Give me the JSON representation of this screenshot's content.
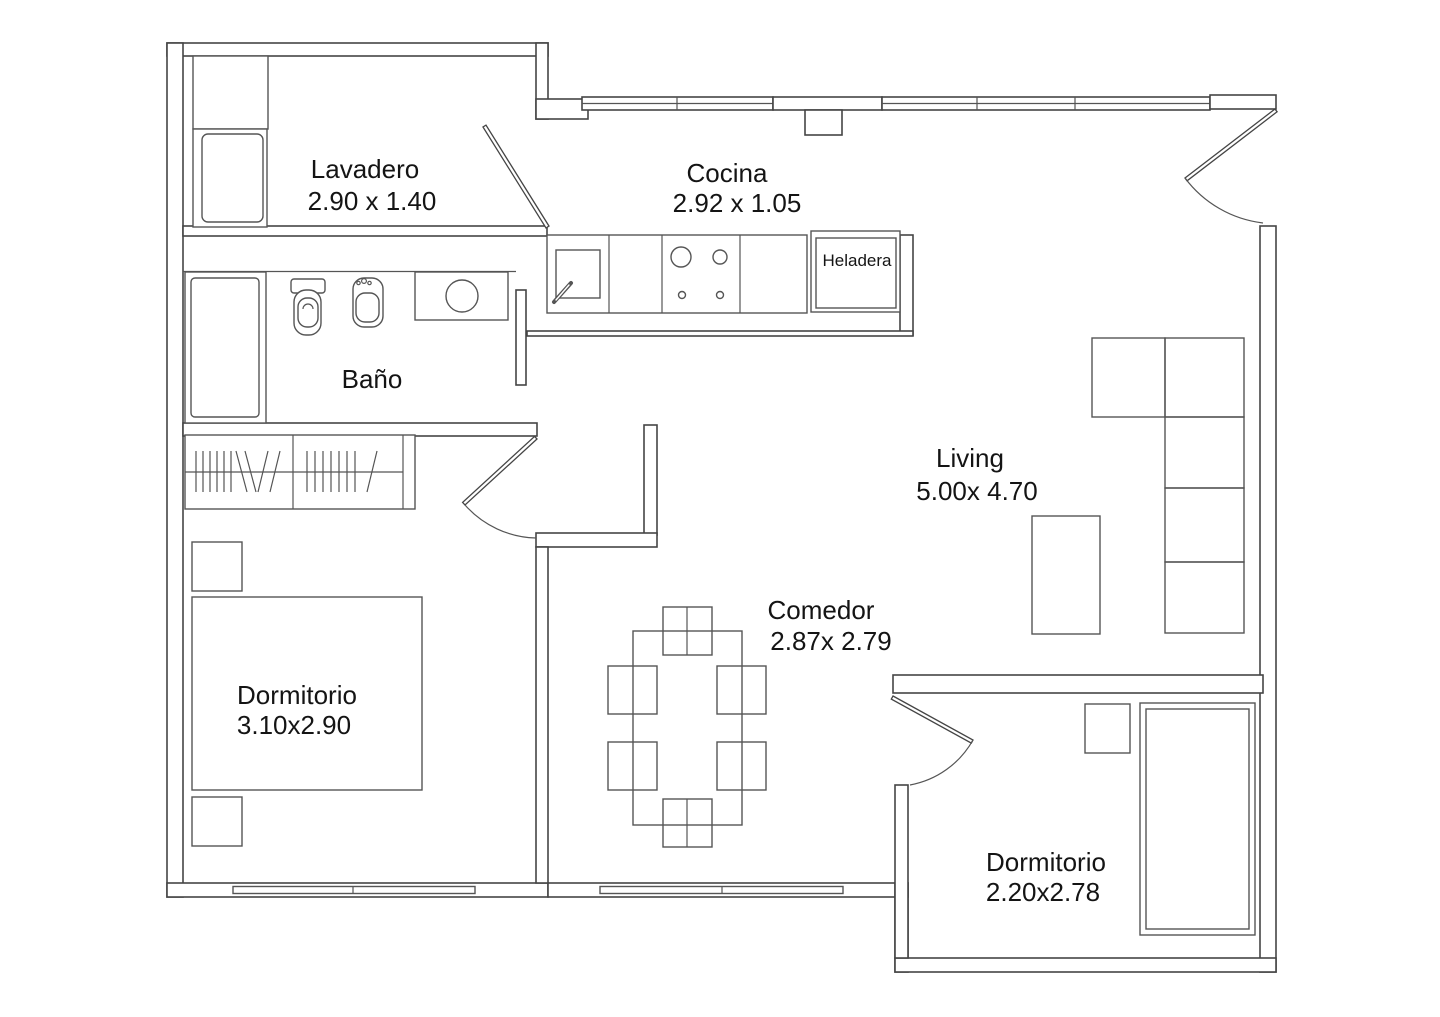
{
  "document": {
    "type": "floor-plan"
  },
  "palette": {
    "background": "#ffffff",
    "line": "#454545",
    "text": "#141414"
  },
  "rooms": {
    "lavadero": {
      "label": "Lavadero",
      "dims": "2.90 x 1.40"
    },
    "cocina": {
      "label": "Cocina",
      "dims": "2.92 x 1.05"
    },
    "bano": {
      "label": "Baño"
    },
    "living": {
      "label": "Living",
      "dims": "5.00x 4.70"
    },
    "comedor": {
      "label": "Comedor",
      "dims": "2.87x 2.79"
    },
    "dormitorio1": {
      "label": "Dormitorio",
      "dims": "3.10x2.90"
    },
    "dormitorio2": {
      "label": "Dormitorio",
      "dims": "2.20x2.78"
    }
  },
  "appliances": {
    "heladera": {
      "label": "Heladera"
    }
  }
}
